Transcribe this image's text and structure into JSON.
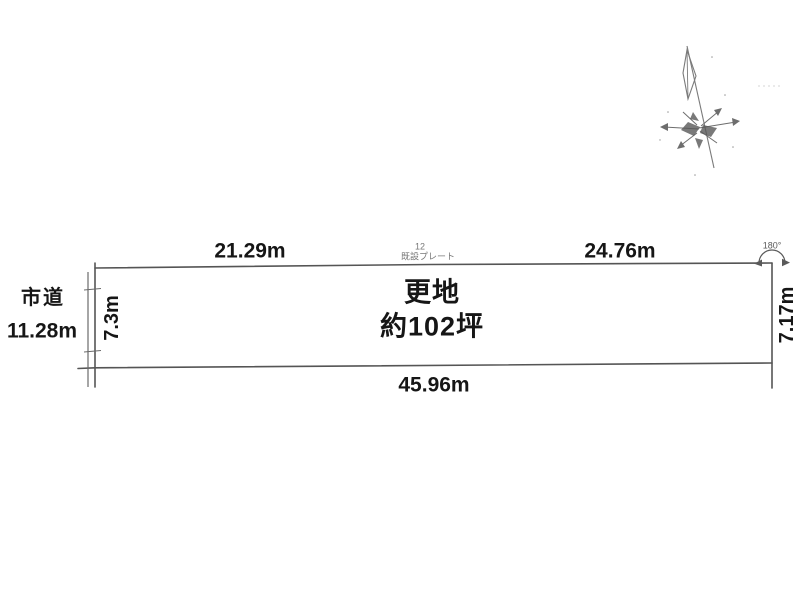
{
  "diagram_title": "land-plot-survey-diagram",
  "plot": {
    "land_use": "更地",
    "land_area": "約102坪",
    "dimensions": {
      "top_left_segment": "21.29m",
      "top_right_segment": "24.76m",
      "bottom": "45.96m",
      "left": "7.3m",
      "right": "7.17m"
    },
    "corner_angle": "180°",
    "marker": {
      "number": "12",
      "label": "既設プレート"
    }
  },
  "road": {
    "name": "市道",
    "width": "11.28m"
  },
  "icons": {
    "compass": "compass-north-icon",
    "angle_arc": "angle-arc-icon"
  },
  "colors": {
    "line": "#555555",
    "text": "#161616",
    "faint": "#777777",
    "background": "#ffffff"
  }
}
